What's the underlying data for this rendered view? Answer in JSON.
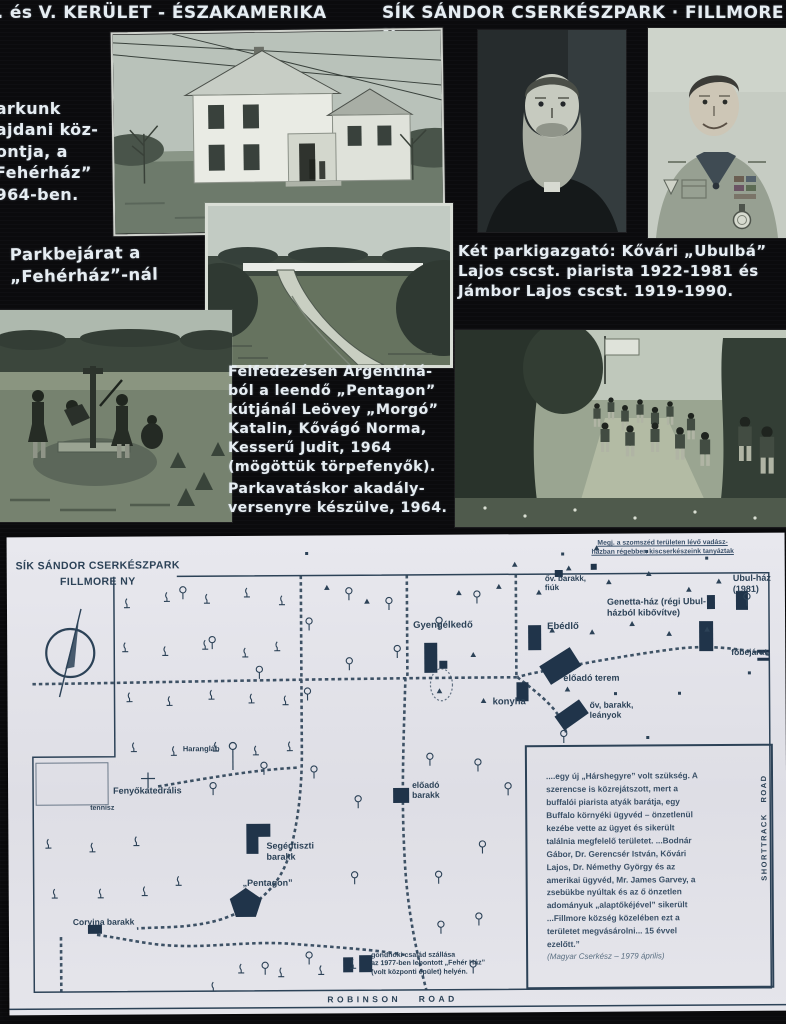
{
  "header": {
    "title_left": "I. és V. KERÜLET - ÉSZAKAMERIKA",
    "title_right": "SÍK SÁNDOR CSERKÉSZPARK · FILLMORE N"
  },
  "captions": {
    "house": [
      "Parkunk",
      "hajdani köz-",
      "pontja, a",
      "„Fehérház”",
      "1964-ben."
    ],
    "entrance": [
      "Parkbejárat a",
      "„Fehérház”-nál"
    ],
    "directors": [
      "Két parkigazgató: Kővári „Ubulbá”",
      "Lajos cscst. piarista 1922-1981 és",
      "Jámbor Lajos cscst. 1919-1990."
    ],
    "discovery": [
      "Felfedezésen Argentíná-",
      "ból a leendő „Pentagon”",
      "kútjánál Leövey „Morgó”",
      "Katalin, Kővágó Norma,",
      "Kesserű Judit, 1964",
      "(mögöttük törpefenyők)."
    ],
    "obstacle": [
      "Parkavatáskor akadály-",
      "versenyre készülve, 1964."
    ]
  },
  "map": {
    "title": [
      "SÍK SÁNDOR CSERKÉSZPARK",
      "FILLMORE NY"
    ],
    "note": [
      "Megj. a szomszéd területen lévő vadász-",
      "házban régebben kiscserkészeink tanyáztak"
    ],
    "labels": [
      {
        "id": "ov-barakk-fiuk",
        "lines": [
          "őv. barakk,",
          "fiúk"
        ],
        "x": 538,
        "y": 40,
        "size": 8
      },
      {
        "id": "gyengelkedo",
        "lines": [
          "Gyengélkedő"
        ],
        "x": 406,
        "y": 85,
        "size": 9.5
      },
      {
        "id": "ebedlo",
        "lines": [
          "Ebédlő"
        ],
        "x": 540,
        "y": 87,
        "size": 9.5
      },
      {
        "id": "genetta-haz",
        "lines": [
          "Genetta-ház (régi Ubul-",
          "házból kibővítve)"
        ],
        "x": 600,
        "y": 63,
        "size": 9
      },
      {
        "id": "ubul-haz",
        "lines": [
          "Ubul-ház",
          "(1981)"
        ],
        "x": 726,
        "y": 40,
        "size": 9
      },
      {
        "id": "fobejarat",
        "lines": [
          "főbejárat"
        ],
        "x": 724,
        "y": 114,
        "size": 8.5
      },
      {
        "id": "eloado-terem",
        "lines": [
          "előadó terem"
        ],
        "x": 556,
        "y": 139,
        "size": 9
      },
      {
        "id": "konyha",
        "lines": [
          "konyha"
        ],
        "x": 485,
        "y": 162,
        "size": 9.5
      },
      {
        "id": "ov-barakk-leanyok",
        "lines": [
          "őv, barakk,",
          "leányok"
        ],
        "x": 582,
        "y": 166,
        "size": 8.5
      },
      {
        "id": "haranglab",
        "lines": [
          "Harangláb"
        ],
        "x": 175,
        "y": 209,
        "size": 7.5
      },
      {
        "id": "fenyokatedralis",
        "lines": [
          "Fenyőkatedrális"
        ],
        "x": 105,
        "y": 249,
        "size": 9
      },
      {
        "id": "tennisz",
        "lines": [
          "tennisz"
        ],
        "x": 82,
        "y": 268,
        "size": 7
      },
      {
        "id": "segedtiszti-barakk",
        "lines": [
          "Segédtiszti",
          "barakk"
        ],
        "x": 258,
        "y": 305,
        "size": 9
      },
      {
        "id": "pentagon",
        "lines": [
          "„Pentagon”"
        ],
        "x": 234,
        "y": 342,
        "size": 9
      },
      {
        "id": "eloado-barakk",
        "lines": [
          "előadó",
          "barakk"
        ],
        "x": 404,
        "y": 245,
        "size": 8.5
      },
      {
        "id": "corvina-barakk",
        "lines": [
          "Corvina barakk"
        ],
        "x": 64,
        "y": 380,
        "size": 8.5
      },
      {
        "id": "gondnoki",
        "lines": [
          "gondnoki család szállása",
          "az 1977-ben lebontott „Fehér Ház”",
          "(volt központi épület) helyén."
        ],
        "x": 362,
        "y": 417,
        "size": 7
      },
      {
        "id": "robinson-road",
        "lines": [
          "ROBINSON   ROAD"
        ],
        "x": 318,
        "y": 459,
        "size": 8.5,
        "spacing": 3.5
      },
      {
        "id": "shorttrack-road",
        "lines": [
          "SHORTTRACK   ROAD"
        ],
        "x": 752,
        "y": 348,
        "size": 7.5,
        "spacing": 1.5,
        "rotate": -90
      }
    ],
    "quote": {
      "lines": [
        "....egy új „Hárshegyre” volt szükség. A",
        "szerencse is közrejátszott, mert a",
        "buffalói piarista atyák barátja, egy",
        "Buffalo környéki ügyvéd – önzetlenül",
        "kezébe vette az ügyet és sikerült",
        "találnia megfelelő területet. ...Bodnár",
        "Gábor, Dr. Gerencsér István, Kővári",
        "Lajos, Dr. Némethy György és az",
        "amerikai ügyvéd, Mr. James Garvey, a",
        "zsebükbe nyúltak és az ő önzetlen",
        "adományuk „alaptőkéjével” sikerült",
        "...Fillmore község közelében ezt a",
        "területet megvásárolni... 15 évvel",
        "ezelőtt.”"
      ],
      "source": "(Magyar Cserkész – 1979 április)"
    }
  },
  "icons": {
    "compass": "compass-icon",
    "conifer_tree": "conifer-tree-icon",
    "round_tree": "round-tree-icon",
    "bell_tower": "bell-tower-icon",
    "cross": "cross-icon"
  },
  "colors": {
    "background": "#0c0c0e",
    "chalk_text": "#e6edf2",
    "map_paper": "#e3e3e9",
    "map_ink": "#2c4257",
    "photo_tint": "#93a89b"
  }
}
